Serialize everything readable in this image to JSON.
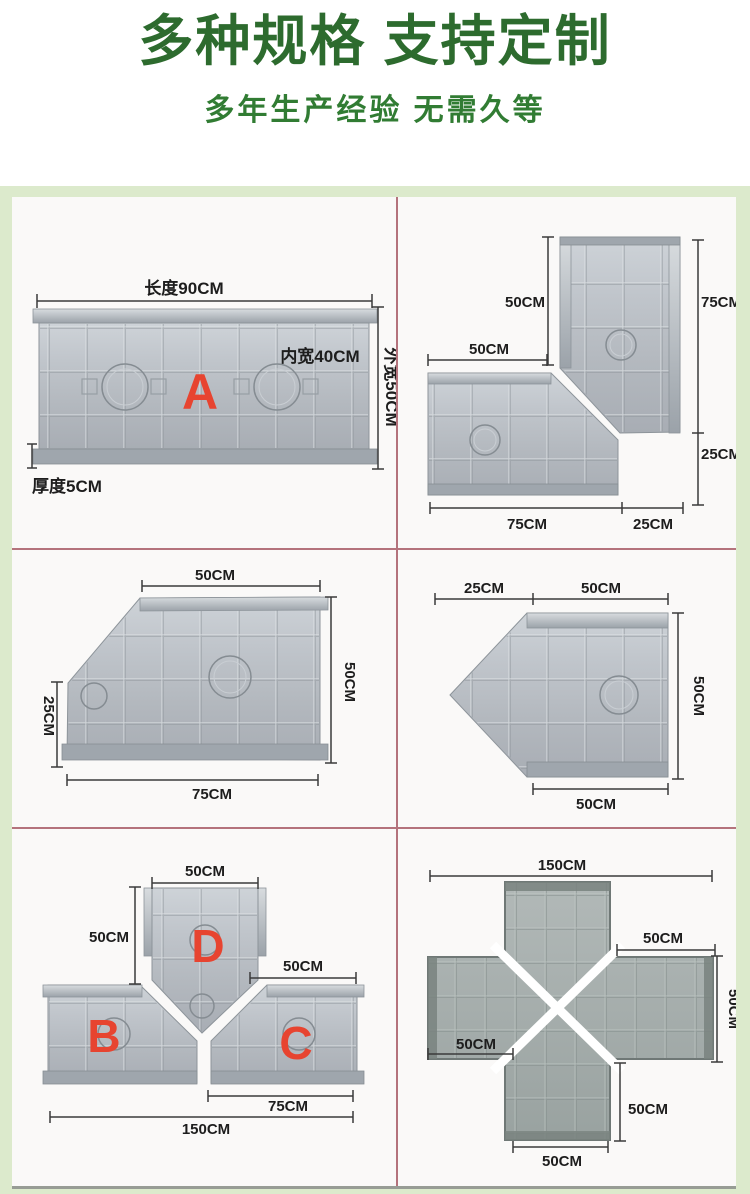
{
  "header": {
    "title": "多种规格 支持定制",
    "subtitle": "多年生产经验 无需久等"
  },
  "colors": {
    "title_green": "#2d6b2e",
    "subtitle_green": "#317c33",
    "board_green": "#dceacc",
    "divider_rose": "#b4737c",
    "label_red": "#e74430",
    "mold_gray": "#b3b8be"
  },
  "panels": {
    "straight": {
      "letter": "A",
      "length": "长度90CM",
      "inner_width": "内宽40CM",
      "outer_width": "外宽50CM",
      "thickness": "厚度5CM"
    },
    "corner": {
      "top_width": "50CM",
      "left_width": "50CM",
      "right_upper": "75CM",
      "right_lower": "25CM",
      "bottom_left": "75CM",
      "bottom_right": "25CM"
    },
    "beveled": {
      "top": "50CM",
      "left": "25CM",
      "right": "50CM",
      "bottom": "75CM"
    },
    "pointed": {
      "top_left": "25CM",
      "top_right": "50CM",
      "right": "50CM",
      "bottom": "50CM"
    },
    "tee": {
      "letter_top": "D",
      "letter_left": "B",
      "letter_right": "C",
      "top": "50CM",
      "left": "50CM",
      "right": "50CM",
      "bottom_right": "75CM",
      "bottom_total": "150CM"
    },
    "cross": {
      "top_total": "150CM",
      "top_right": "50CM",
      "right": "50CM",
      "left": "50CM",
      "bottom_right": "50CM",
      "bottom": "50CM"
    }
  }
}
